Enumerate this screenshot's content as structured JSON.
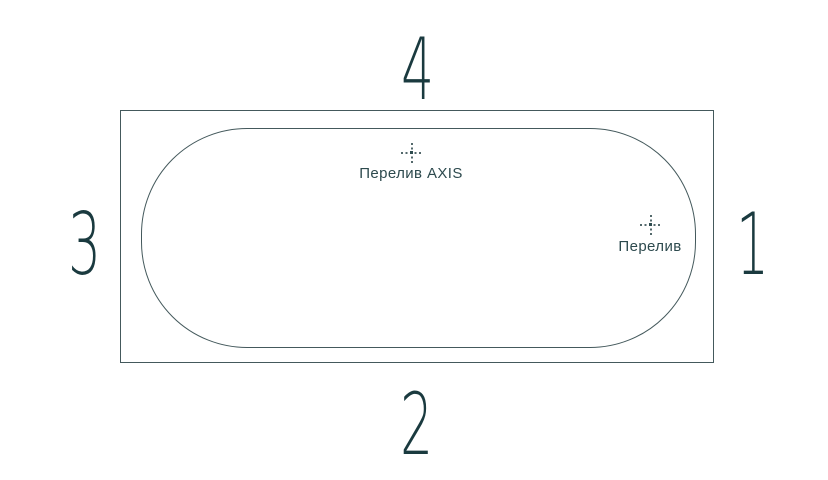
{
  "colors": {
    "background": "#ffffff",
    "outline": "#44595c",
    "number_text": "#1a3a3f",
    "label_text": "#2d4a4e",
    "crosshair": "#54696c"
  },
  "diagram": {
    "type": "bathtub-top-view",
    "sides": {
      "top": "4",
      "bottom": "2",
      "left": "3",
      "right": "1"
    },
    "markers": {
      "overflow_axis": "Перелив AXIS",
      "overflow": "Перелив"
    }
  }
}
